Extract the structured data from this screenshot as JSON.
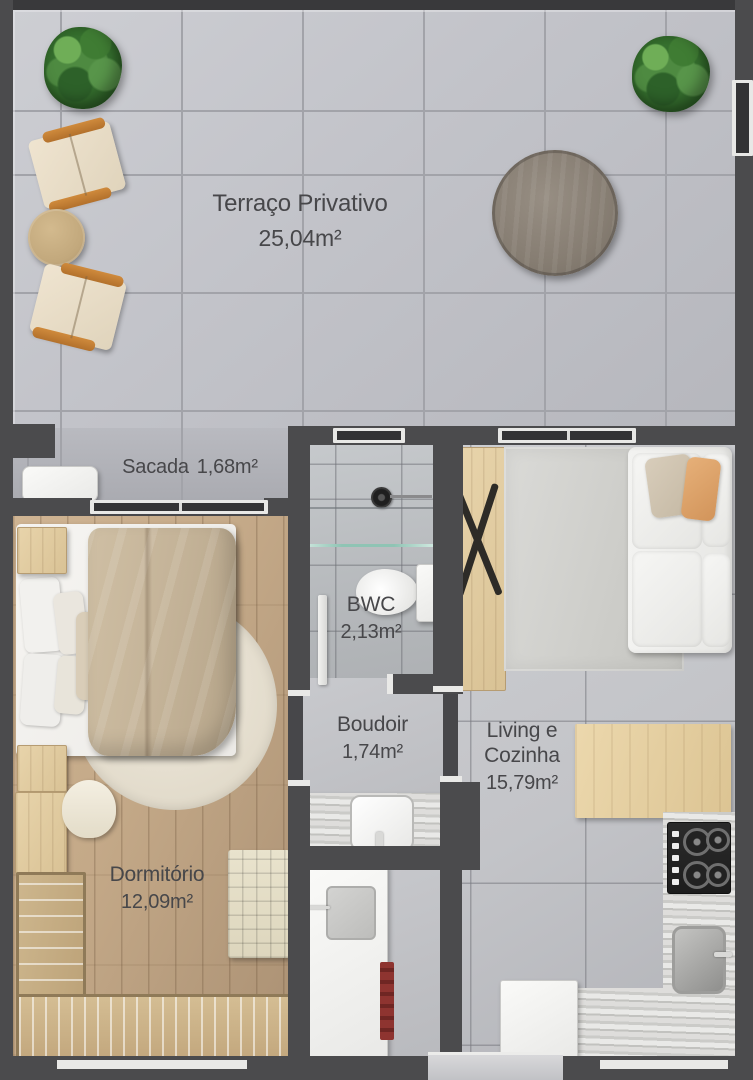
{
  "rooms": {
    "terraco": {
      "name": "Terraço Privativo",
      "area": "25,04m²"
    },
    "sacada": {
      "name": "Sacada",
      "area": "1,68m²"
    },
    "bwc": {
      "name": "BWC",
      "area": "2,13m²"
    },
    "boudoir": {
      "name": "Boudoir",
      "area": "1,74m²"
    },
    "living": {
      "name": "Living e Cozinha",
      "area": "15,79m²"
    },
    "dormitorio": {
      "name": "Dormitório",
      "area": "12,09m²"
    }
  },
  "colors": {
    "wall": "#4b4b4d",
    "terrace_tile": "#c2c3c9",
    "interior_floor": "#c3c4c8",
    "wood_floor": "#c4a988",
    "label_text": "#47474a",
    "plant_green": "#356f2e",
    "accent_orange": "#c98b3e",
    "glass_partition": "#8fc4b4"
  }
}
